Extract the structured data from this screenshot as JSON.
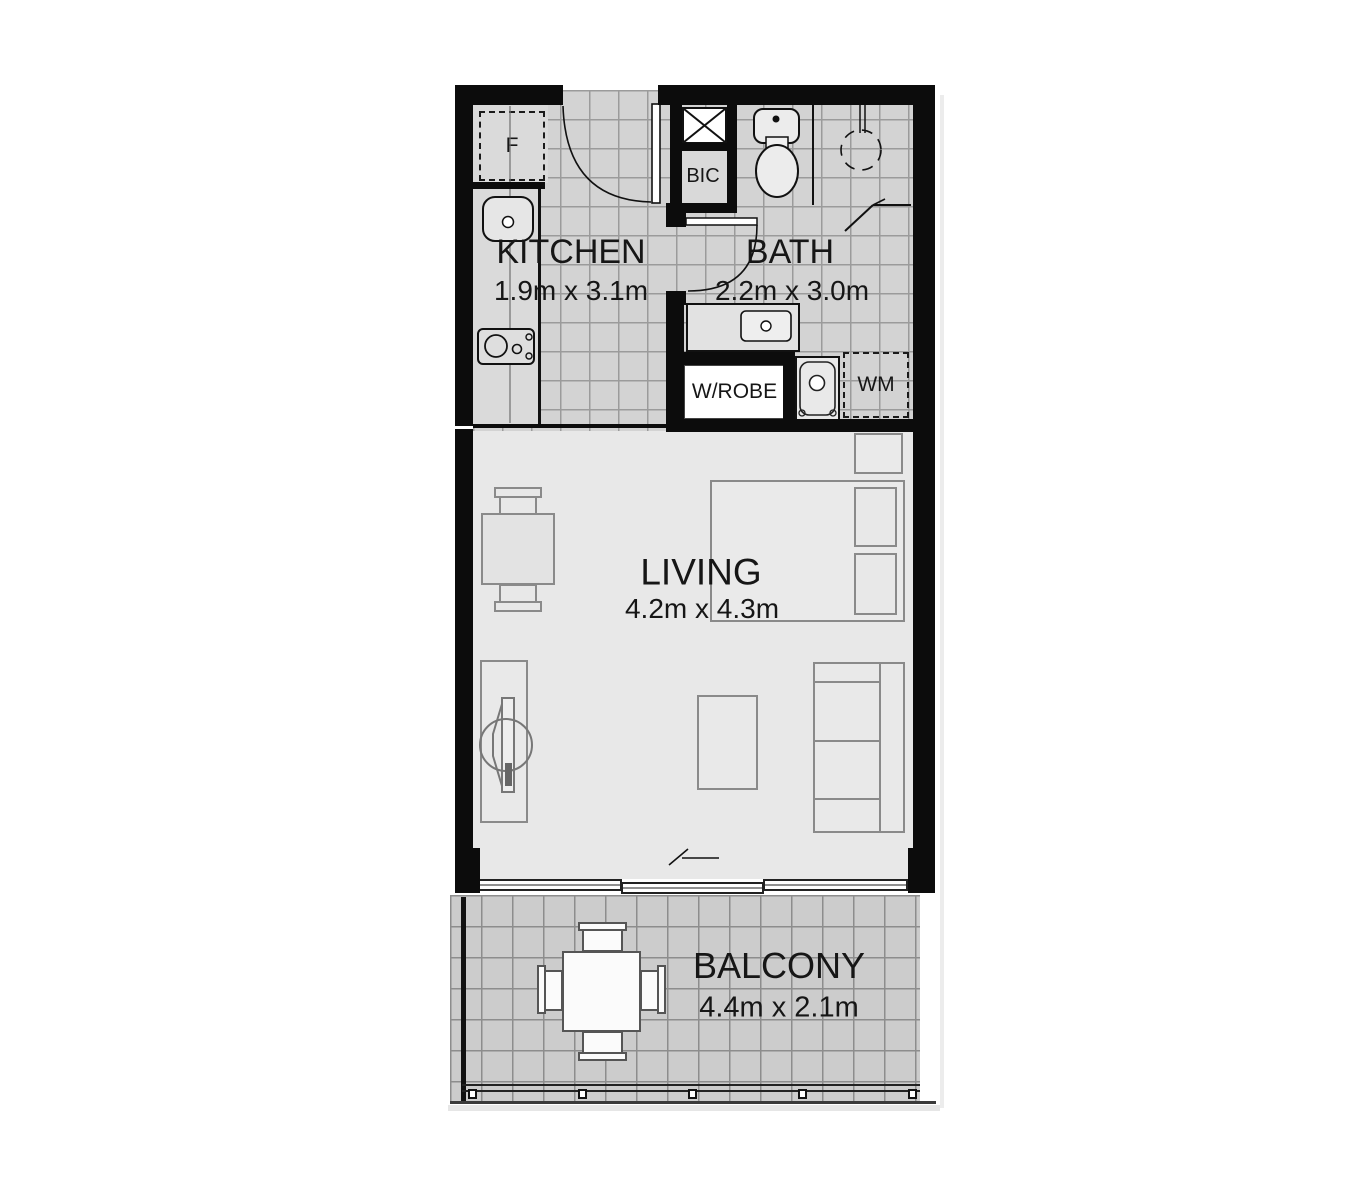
{
  "floor_plan": {
    "rooms": {
      "kitchen": {
        "name": "KITCHEN",
        "dimensions": "1.9m x 3.1m"
      },
      "bath": {
        "name": "BATH",
        "dimensions": "2.2m x 3.0m"
      },
      "living": {
        "name": "LIVING",
        "dimensions": "4.2m x 4.3m"
      },
      "balcony": {
        "name": "BALCONY",
        "dimensions": "4.4m x 2.1m"
      }
    },
    "labels": {
      "built_in_cupboard": "BIC",
      "wardrobe": "W/ROBE",
      "washing_machine": "WM",
      "fridge": "F"
    },
    "colors": {
      "wall": "#0c0c0c",
      "tile_floor": "#d3d3d3",
      "tile_grid_line": "#9b9b9b",
      "living_floor": "#e8e8e8",
      "balcony_floor": "#cccccc",
      "balcony_grid_line": "#8d8d8d",
      "fixture_outline": "#111111",
      "furniture_outline": "#8a8a8a"
    }
  }
}
